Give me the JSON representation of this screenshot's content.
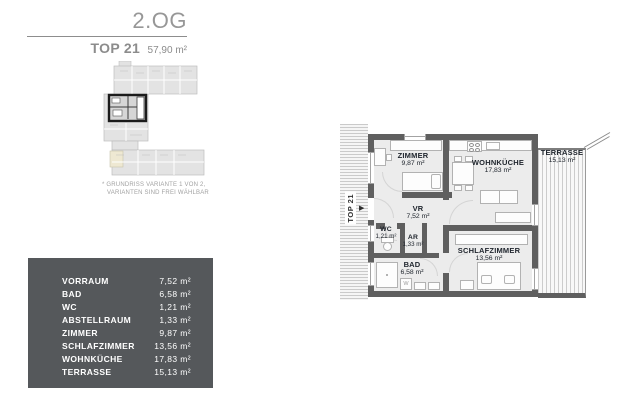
{
  "header": {
    "floor_label": "2.OG",
    "unit_label": "TOP 21",
    "total_area": "57,90 m²"
  },
  "note": {
    "line1": "* GRUNDRISS VARIANTE 1 VON 2,",
    "line2": "VARIANTEN SIND FREI WÄHLBAR"
  },
  "area_table": {
    "rows": [
      {
        "label": "VORRAUM",
        "value": "7,52 m²"
      },
      {
        "label": "BAD",
        "value": "6,58 m²"
      },
      {
        "label": "WC",
        "value": "1,21 m²"
      },
      {
        "label": "ABSTELLRAUM",
        "value": "1,33 m²"
      },
      {
        "label": "ZIMMER",
        "value": "9,87 m²"
      },
      {
        "label": "SCHLAFZIMMER",
        "value": "13,56 m²"
      },
      {
        "label": "WOHNKÜCHE",
        "value": "17,83 m²"
      },
      {
        "label": "TERRASSE",
        "value": "15,13 m²"
      }
    ]
  },
  "floorplan": {
    "unit_tag": "TOP 21",
    "washer_label": "W",
    "rooms": {
      "zimmer": {
        "name": "ZIMMER",
        "area": "9,87 m²"
      },
      "wohnkueche": {
        "name": "WOHNKÜCHE",
        "area": "17,83 m²"
      },
      "vr": {
        "name": "VR",
        "area": "7,52 m²"
      },
      "wc": {
        "name": "WC",
        "area": "1,21 m²"
      },
      "ar": {
        "name": "AR",
        "area": "1,33 m²"
      },
      "bad": {
        "name": "BAD",
        "area": "6,58 m²"
      },
      "schlafzimmer": {
        "name": "SCHLAFZIMMER",
        "area": "13,56 m²"
      },
      "terrasse": {
        "name": "TERRASSE",
        "area": "15,13 m²"
      }
    }
  },
  "colors": {
    "wall": "#5f5f5f",
    "room_bg": "#ececec",
    "table_bg": "#55585b",
    "label_text": "#20262e",
    "header_text": "#8c8c8c"
  }
}
